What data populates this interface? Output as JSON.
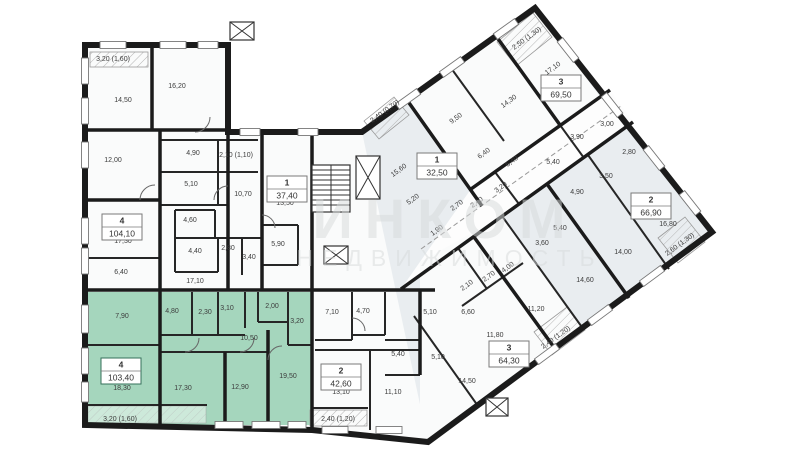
{
  "watermark": {
    "line1": "ИНКОМ",
    "line2": "НЕДВИЖИМОСТЬ"
  },
  "colors": {
    "highlight": "#a5d6bd",
    "highlight_light": "#cde9da",
    "wing_tint": "#e9edf0",
    "watermark": "#d7dadb",
    "walls": "#1b1b1b"
  },
  "apartments": [
    {
      "number": "4",
      "area": "104,10",
      "x": 122,
      "y": 227,
      "highlighted": false
    },
    {
      "number": "1",
      "area": "37,40",
      "x": 287,
      "y": 189,
      "highlighted": false
    },
    {
      "number": "1",
      "area": "32,50",
      "x": 437,
      "y": 166,
      "highlighted": false
    },
    {
      "number": "3",
      "area": "69,50",
      "x": 561,
      "y": 88,
      "highlighted": false
    },
    {
      "number": "2",
      "area": "66,90",
      "x": 651,
      "y": 206,
      "highlighted": false
    },
    {
      "number": "3",
      "area": "64,30",
      "x": 509,
      "y": 354,
      "highlighted": false
    },
    {
      "number": "2",
      "area": "42,60",
      "x": 341,
      "y": 377,
      "highlighted": false
    },
    {
      "number": "4",
      "area": "103,40",
      "x": 121,
      "y": 371,
      "highlighted": true
    }
  ],
  "room_labels": [
    {
      "t": "3,20 (1,60)",
      "x": 113,
      "y": 61
    },
    {
      "t": "14,50",
      "x": 123,
      "y": 102
    },
    {
      "t": "16,20",
      "x": 177,
      "y": 88
    },
    {
      "t": "12,00",
      "x": 113,
      "y": 162
    },
    {
      "t": "4,90",
      "x": 193,
      "y": 155
    },
    {
      "t": "2,10 (1,10)",
      "x": 236,
      "y": 157
    },
    {
      "t": "5,10",
      "x": 191,
      "y": 186
    },
    {
      "t": "10,70",
      "x": 243,
      "y": 196
    },
    {
      "t": "4,60",
      "x": 190,
      "y": 222
    },
    {
      "t": "17,30",
      "x": 123,
      "y": 243
    },
    {
      "t": "4,40",
      "x": 195,
      "y": 253
    },
    {
      "t": "2,80",
      "x": 228,
      "y": 250
    },
    {
      "t": "3,40",
      "x": 249,
      "y": 259
    },
    {
      "t": "6,40",
      "x": 121,
      "y": 274
    },
    {
      "t": "17,10",
      "x": 195,
      "y": 283
    },
    {
      "t": "13,50",
      "x": 285,
      "y": 205
    },
    {
      "t": "5,90",
      "x": 278,
      "y": 246
    },
    {
      "t": "7,90",
      "x": 122,
      "y": 318
    },
    {
      "t": "4,80",
      "x": 172,
      "y": 313
    },
    {
      "t": "2,30",
      "x": 205,
      "y": 314
    },
    {
      "t": "3,10",
      "x": 227,
      "y": 310
    },
    {
      "t": "2,00",
      "x": 272,
      "y": 308
    },
    {
      "t": "3,20",
      "x": 297,
      "y": 323
    },
    {
      "t": "10,50",
      "x": 249,
      "y": 340
    },
    {
      "t": "18,30",
      "x": 122,
      "y": 390
    },
    {
      "t": "17,30",
      "x": 183,
      "y": 390
    },
    {
      "t": "12,90",
      "x": 240,
      "y": 389
    },
    {
      "t": "19,50",
      "x": 288,
      "y": 378
    },
    {
      "t": "3,20 (1,60)",
      "x": 120,
      "y": 421
    },
    {
      "t": "7,10",
      "x": 332,
      "y": 314
    },
    {
      "t": "4,70",
      "x": 363,
      "y": 313
    },
    {
      "t": "5,10",
      "x": 430,
      "y": 314
    },
    {
      "t": "5,40",
      "x": 398,
      "y": 356
    },
    {
      "t": "5,10",
      "x": 438,
      "y": 359
    },
    {
      "t": "13,10",
      "x": 341,
      "y": 394
    },
    {
      "t": "11,10",
      "x": 393,
      "y": 394
    },
    {
      "t": "2,40 (1,20)",
      "x": 338,
      "y": 421
    },
    {
      "t": "2,40 (0,70)",
      "x": 386,
      "y": 113,
      "r": -36
    },
    {
      "t": "15,60",
      "x": 400,
      "y": 172,
      "r": -36
    },
    {
      "t": "9,50",
      "x": 457,
      "y": 120,
      "r": -36
    },
    {
      "t": "14,30",
      "x": 510,
      "y": 103,
      "r": -36
    },
    {
      "t": "17,10",
      "x": 554,
      "y": 70,
      "r": -36
    },
    {
      "t": "2,50 (1,30)",
      "x": 528,
      "y": 40,
      "r": -36
    },
    {
      "t": "5,20",
      "x": 414,
      "y": 201,
      "r": -36
    },
    {
      "t": "1,90",
      "x": 438,
      "y": 232,
      "r": -36
    },
    {
      "t": "2,70",
      "x": 458,
      "y": 207,
      "r": -36
    },
    {
      "t": "2,40",
      "x": 478,
      "y": 204,
      "r": -36
    },
    {
      "t": "6,40",
      "x": 485,
      "y": 155,
      "r": -36
    },
    {
      "t": "5,40",
      "x": 513,
      "y": 163,
      "r": -36
    },
    {
      "t": "3,20",
      "x": 502,
      "y": 189,
      "r": -36
    },
    {
      "t": "4,00",
      "x": 509,
      "y": 269,
      "r": -36
    },
    {
      "t": "2,70",
      "x": 490,
      "y": 278,
      "r": -36
    },
    {
      "t": "2,10",
      "x": 468,
      "y": 287,
      "r": -36
    },
    {
      "t": "3,00",
      "x": 607,
      "y": 126
    },
    {
      "t": "3,90",
      "x": 577,
      "y": 139
    },
    {
      "t": "2,80",
      "x": 629,
      "y": 154
    },
    {
      "t": "3,50",
      "x": 606,
      "y": 178
    },
    {
      "t": "4,90",
      "x": 577,
      "y": 194
    },
    {
      "t": "5,40",
      "x": 553,
      "y": 164
    },
    {
      "t": "5,40",
      "x": 560,
      "y": 230
    },
    {
      "t": "3,60",
      "x": 542,
      "y": 245
    },
    {
      "t": "14,00",
      "x": 623,
      "y": 254
    },
    {
      "t": "16,80",
      "x": 668,
      "y": 226
    },
    {
      "t": "2,60 (1,30)",
      "x": 681,
      "y": 246,
      "r": -36
    },
    {
      "t": "14,60",
      "x": 585,
      "y": 282
    },
    {
      "t": "11,20",
      "x": 536,
      "y": 311
    },
    {
      "t": "6,60",
      "x": 468,
      "y": 314
    },
    {
      "t": "11,80",
      "x": 495,
      "y": 337
    },
    {
      "t": "2,40 (1,20)",
      "x": 557,
      "y": 339,
      "r": -36
    },
    {
      "t": "14,50",
      "x": 467,
      "y": 383
    }
  ]
}
